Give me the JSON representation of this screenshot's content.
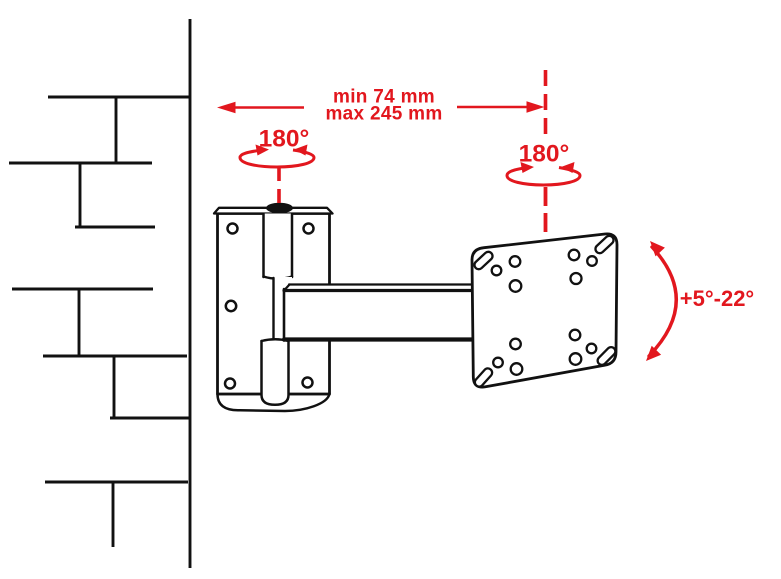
{
  "diagram": {
    "kind": "tv-wall-mount-articulating-arm-spec-diagram"
  },
  "colors": {
    "accent": "#e2171e",
    "line": "#111111",
    "background": "#ffffff"
  },
  "labels": {
    "extension_min": "min 74 mm",
    "extension_max": "max 245 mm",
    "swivel_wall": "180°",
    "swivel_plate": "180°",
    "tilt_range": "+5°-22°"
  }
}
